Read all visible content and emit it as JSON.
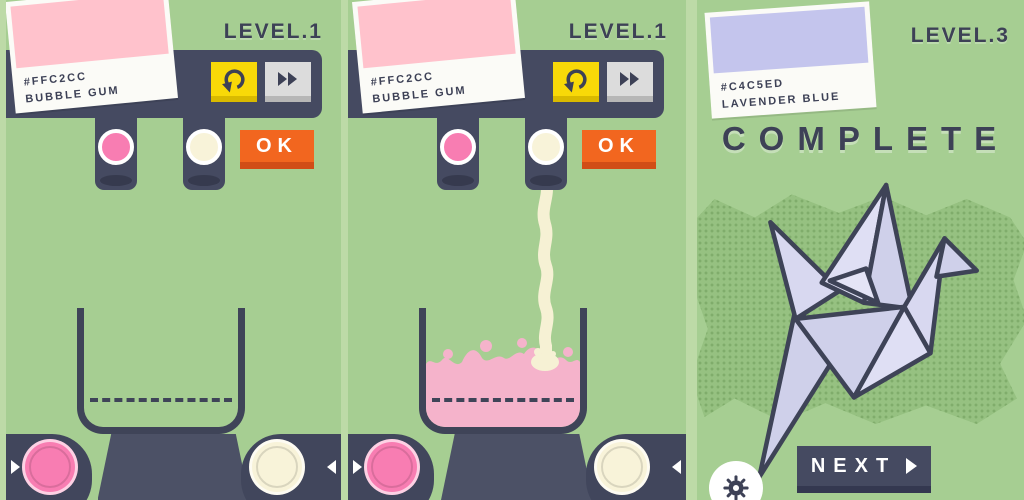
{
  "panels": {
    "p1": {
      "level": "LEVEL.1",
      "card": {
        "hex": "#FFC2CC",
        "name": "BUBBLE GUM"
      },
      "ok_label": "OK",
      "dispensers": [
        {
          "name": "pink",
          "color": "#F87DB2"
        },
        {
          "name": "cream",
          "color": "#F8F3D9"
        }
      ]
    },
    "p2": {
      "level": "LEVEL.1",
      "card": {
        "hex": "#FFC2CC",
        "name": "BUBBLE GUM"
      },
      "ok_label": "OK",
      "dispensers": [
        {
          "name": "pink",
          "color": "#F87DB2"
        },
        {
          "name": "cream",
          "color": "#F8F3D9"
        }
      ]
    },
    "p3": {
      "level": "LEVEL.3",
      "card": {
        "hex": "#C4C5ED",
        "name": "LAVENDER BLUE"
      },
      "status_label": "COMPLETE",
      "next_label": "NEXT"
    }
  },
  "icons": {
    "undo": "rotate-counterclockwise-arrow",
    "fast_forward": "double-right-triangles",
    "gear": "settings-gear",
    "next_arrow": "right-triangle",
    "left_pill_arrow": "right-triangle",
    "right_pill_arrow": "left-triangle",
    "crane": "origami-paper-crane"
  },
  "colors": {
    "background_green": "#A6CE92",
    "panel_divider": "#BDDAA7",
    "slate_dark": "#454A61",
    "text_dark": "#3D4156",
    "undo_yellow": "#F8D908",
    "fast_forward_gray": "#DCDCDC",
    "ok_orange": "#F2661F",
    "pink_ingredient": "#F87DB2",
    "cream_ingredient": "#F8F3D9",
    "liquid_pink": "#F5B3CB",
    "stream_cream": "#F6F1D4",
    "crane_lavender": "#CFD0EA",
    "card_white": "#FBFBF7"
  }
}
